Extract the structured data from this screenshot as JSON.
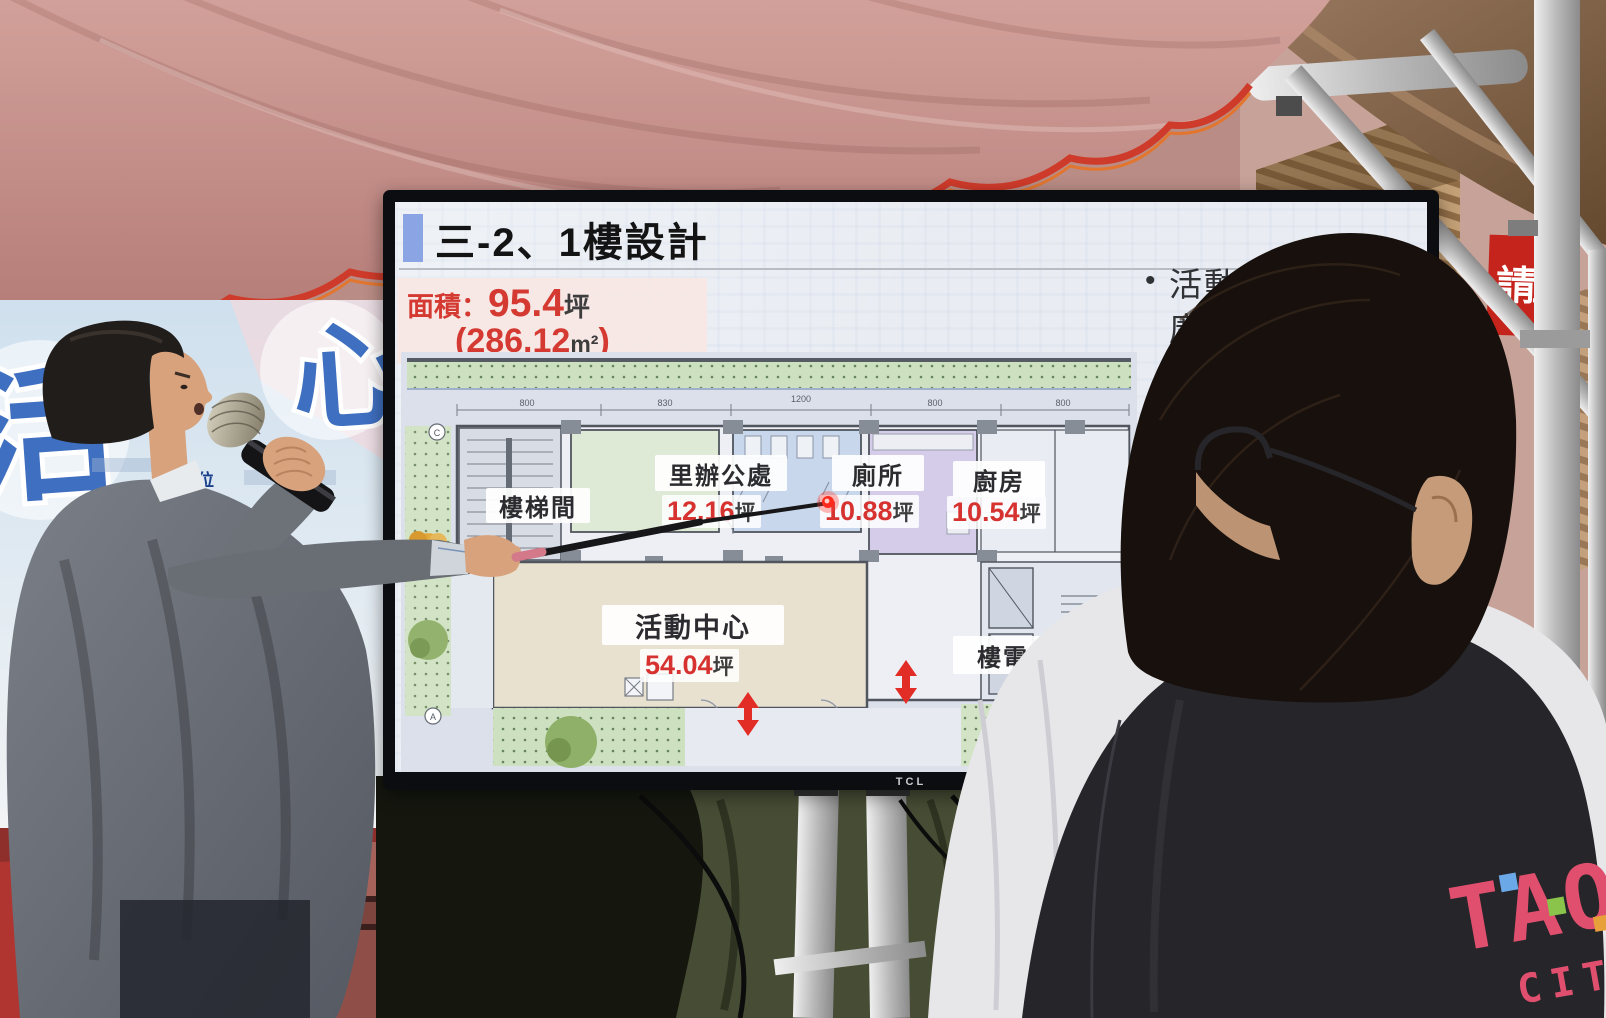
{
  "slide": {
    "title": "三-2、1樓設計",
    "area": {
      "label": "面積：",
      "value": "95.4",
      "unit": "坪",
      "open": "(",
      "m2": "286.12",
      "m2_unit": "m²",
      "close": ")"
    },
    "rooms": {
      "stair": {
        "name": "樓梯間"
      },
      "office": {
        "name": "里辦公處",
        "area": "12.16",
        "unit": "坪"
      },
      "toilet": {
        "name": "廁所",
        "area": "10.88",
        "unit": "坪"
      },
      "kitchen": {
        "name": "廚房",
        "area": "10.54",
        "unit": "坪"
      },
      "activity": {
        "name": "活動中心",
        "area": "54.04",
        "unit": "坪"
      },
      "elevator": {
        "name": "樓電梯間"
      }
    },
    "bullets": {
      "marker": "•",
      "b1": {
        "l1": "活動中",
        "l2": "廣場",
        "l3": "便",
        "l4": "動"
      },
      "b2": {
        "l1": "配",
        "l2": "備",
        "l3": "餐",
        "l4": "使用"
      },
      "b3": {
        "l1": "配置無障",
        "l2": "梯二座，",
        "l3": "座，友",
        "l4": "用者"
      }
    },
    "dims": {
      "d1": "800",
      "d2": "830",
      "d3": "1200",
      "d4": "800",
      "d5": "800"
    },
    "plan_markers": {
      "top": "C",
      "bottom": "A"
    },
    "colors": {
      "accent_red": "#d63230",
      "title_square_blue": "#8aa4e4"
    }
  },
  "tv": {
    "brand": "TCL"
  },
  "environment": {
    "sign": {
      "char1": "請",
      "char2": "至"
    },
    "banner": {
      "char1": "活",
      "char2": "心",
      "small_text": "單位"
    },
    "vest": {
      "line1": "TAO",
      "line2": "CITY"
    }
  }
}
